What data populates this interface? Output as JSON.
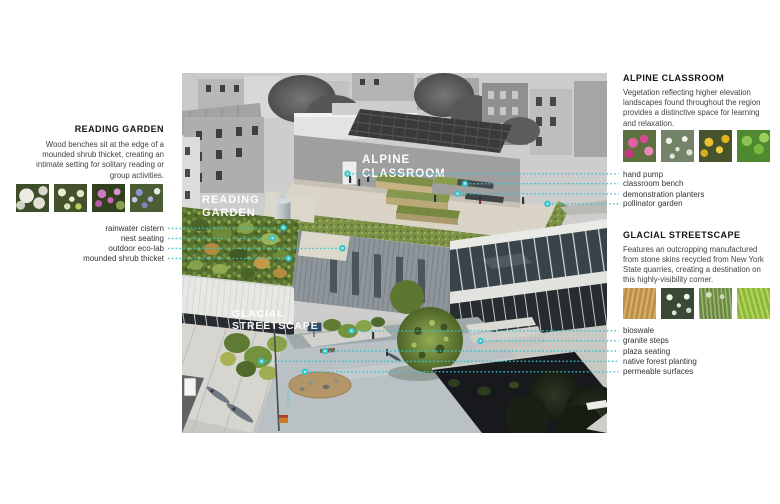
{
  "colors": {
    "accent_cyan": "#35c4cd",
    "heading_text": "#141414",
    "body_text": "#424242",
    "callout_text": "#333333",
    "photo_label_text": "#ffffff"
  },
  "photo": {
    "labels": {
      "alpine": [
        "ALPINE",
        "CLASSROOM"
      ],
      "reading": [
        "READING",
        "GARDEN"
      ],
      "glacial": [
        "GLACIAL",
        "STREETSCAPE"
      ]
    }
  },
  "left_panel": {
    "heading": "READING GARDEN",
    "description_lines": [
      "Wood benches sit at the edge of a",
      "mounded shrub thicket, creating an",
      "intimate setting for solitary reading or",
      "group activities."
    ],
    "callouts": [
      "rainwater cistern",
      "nest seating",
      "outdoor eco-lab",
      "mounded shrub thicket"
    ]
  },
  "right_top_panel": {
    "heading": "ALPINE CLASSROOM",
    "description_lines": [
      "Vegetation reflecting higher elevation",
      "landscapes found throughout the region",
      "provides a distinctive space for learning",
      "and relaxation."
    ],
    "callouts": [
      "hand pump",
      "classroom bench",
      "demonstration planters",
      "pollinator garden"
    ]
  },
  "right_bottom_panel": {
    "heading": "GLACIAL STREETSCAPE",
    "description_lines": [
      "Features an outcropping manufactured",
      "from stone skins recycled from New York",
      "State quarries, creating a destination on",
      "this highly-visibility corner."
    ],
    "callouts": [
      "bioswale",
      "granite steps",
      "plaza seating",
      "native forest planting",
      "permeable surfaces"
    ]
  }
}
